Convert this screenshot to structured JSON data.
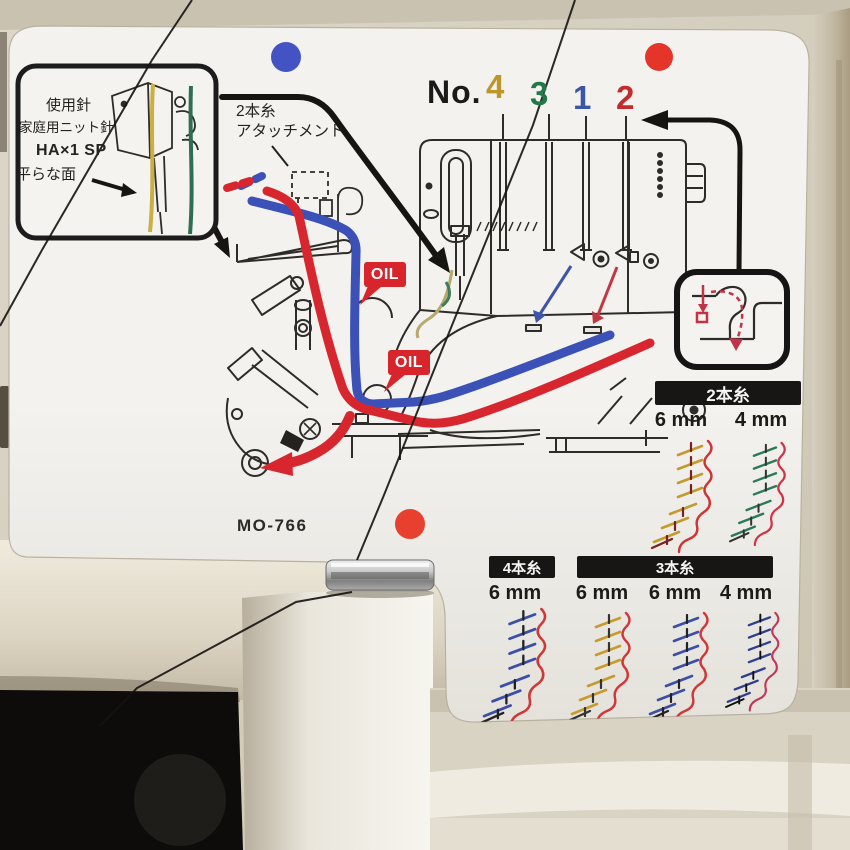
{
  "panel": {
    "model": "MO-766",
    "thread_numbers": {
      "label": "No.",
      "digits": [
        {
          "value": "4",
          "color": "#bd952a"
        },
        {
          "value": "3",
          "color": "#23784a"
        },
        {
          "value": "1",
          "color": "#3a57a7"
        },
        {
          "value": "2",
          "color": "#c42b2d"
        }
      ]
    },
    "needle_box": {
      "lines": [
        "使用針",
        "家庭用ニット針",
        "HA×1 SP",
        "平らな面"
      ]
    },
    "attachment": {
      "lines": [
        "2本糸",
        "アタッチメント"
      ]
    },
    "oil_label": "OIL",
    "stitch_tables": {
      "two_thread": {
        "title": "2本糸",
        "widths": [
          "6 mm",
          "4 mm"
        ]
      },
      "four_thread": {
        "title": "4本糸",
        "widths": [
          "6 mm"
        ]
      },
      "three_thread": {
        "title": "3本糸",
        "widths": [
          "6 mm",
          "6 mm",
          "4 mm"
        ]
      }
    },
    "indicator_dots": {
      "blue": "#4353c3",
      "red_top": "#e5352b",
      "red_mid": "#e8402e"
    },
    "thread_path_colors": {
      "needle_thread": "#3b51b8",
      "looper_thread": "#d8262e"
    },
    "stitch_sample_colors": [
      [
        "#c39a2d",
        "#cf3333"
      ],
      [
        "#2c7a55",
        "#cf3348"
      ],
      [
        "#3b4ea8",
        "#cf3838"
      ],
      [
        "#c79a2d",
        "#cf3838"
      ],
      [
        "#3b4ea8",
        "#cf3838"
      ],
      [
        "#2f3e8e",
        "#c3365a"
      ]
    ]
  }
}
